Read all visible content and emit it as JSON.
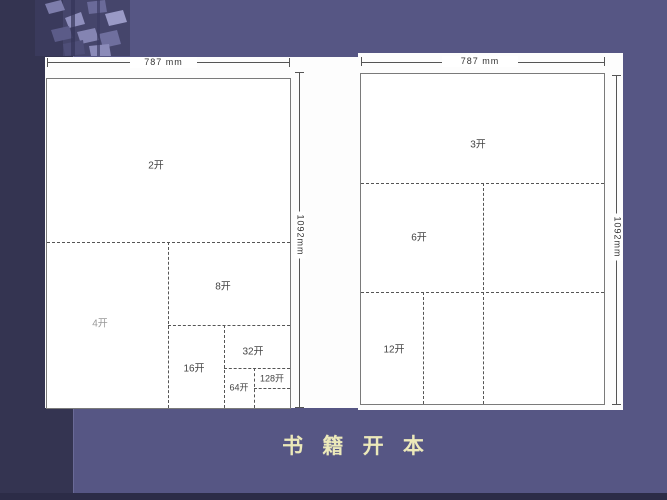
{
  "slide": {
    "title": "书 籍 开 本"
  },
  "left_diagram": {
    "width_dimension": "787 mm",
    "height_dimension": "1092mm",
    "labels": {
      "k2": "2开",
      "k4": "4开",
      "k8": "8开",
      "k16": "16开",
      "k32": "32开",
      "k64": "64开",
      "k128": "128开"
    }
  },
  "right_diagram": {
    "width_dimension": "787 mm",
    "height_dimension": "1092mm",
    "labels": {
      "k3": "3开",
      "k6": "6开",
      "k12": "12开"
    }
  },
  "colors": {
    "background": "#565684",
    "sidebar": "#343451",
    "bottom_strip": "#2c2c47",
    "title_text": "#ece9ba",
    "paper": "#ffffff"
  }
}
